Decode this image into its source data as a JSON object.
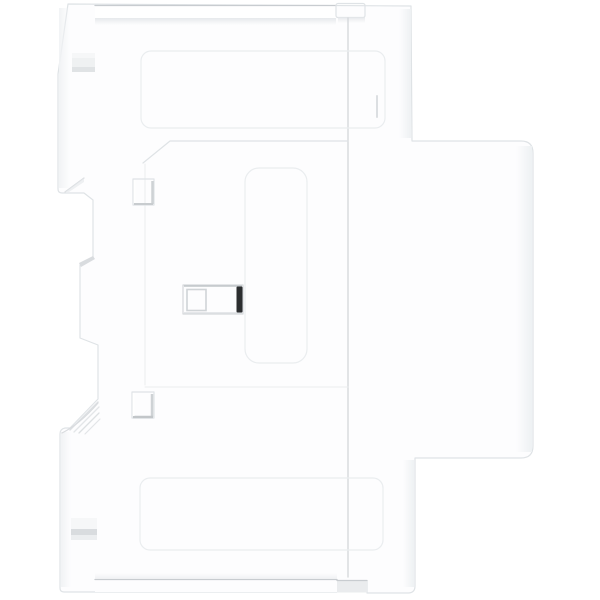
{
  "scene": {
    "type": "product-photo",
    "description": "Side view of a white modular DIN-rail electrical device (contactor / relay module) photographed on a plain white background",
    "background_color": "#ffffff"
  },
  "device": {
    "label": "white-din-rail-module",
    "view": "side profile, front housing to the right, DIN-rail mounting profile to the left",
    "finish": "matte white plastic"
  },
  "parts": [
    {
      "name": "upper-terminal-block",
      "description": "upper narrow housing section with top wiring groove"
    },
    {
      "name": "front-bulge",
      "description": "central protruding front housing section with rounded right corners"
    },
    {
      "name": "lower-terminal-block",
      "description": "lower narrow housing section with bottom groove"
    },
    {
      "name": "top-rear-fin",
      "description": "upper rear mounting fin with vent slot"
    },
    {
      "name": "bottom-rear-fin",
      "description": "lower rear mounting fin with vent slot and ridged clip wedge"
    },
    {
      "name": "top-groove",
      "description": "recessed strip along the top edge"
    },
    {
      "name": "top-clip-tab",
      "description": "small white tab at right end of top groove"
    },
    {
      "name": "bottom-groove",
      "description": "recessed strip along the bottom edge"
    },
    {
      "name": "bottom-clip-notch",
      "description": "recessed notch at right end of bottom groove"
    },
    {
      "name": "housing-seam",
      "description": "vertical seam between side cover and front housing"
    },
    {
      "name": "center-slot",
      "description": "rectangular recess in the side face holding a dark retaining bar"
    },
    {
      "name": "center-slot-dark-bar",
      "description": "dark vertical bar inside the center slot"
    },
    {
      "name": "upper-square-port",
      "description": "small square opening in upper side face"
    },
    {
      "name": "lower-square-port",
      "description": "small square opening in lower side face"
    },
    {
      "name": "din-clip-ridges",
      "description": "diagonal grip ridges on the lower clip wedge"
    }
  ],
  "colors": {
    "background": "#ffffff",
    "body": "#fdfdfe",
    "edge": "#dfe3e6",
    "line_faint": "#eaedef",
    "groove_line": "#c8ccd0",
    "recess_light": "#f3f4f6",
    "shadow": "#d9dcdf",
    "slot_bar": "#2c2e30"
  }
}
